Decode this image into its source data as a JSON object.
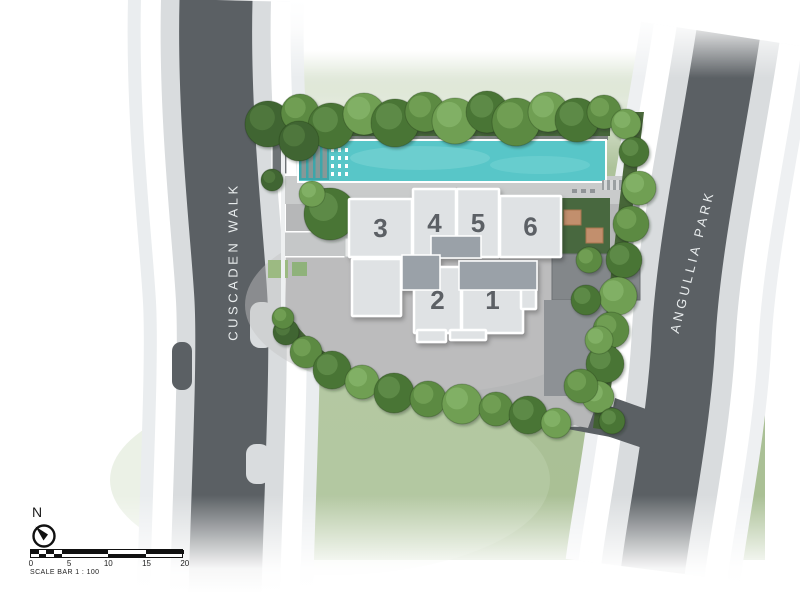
{
  "canvas": {
    "width": 800,
    "height": 593
  },
  "roads": {
    "left_label": "CUSCADEN WALK",
    "right_label": "ANGULLIA PARK"
  },
  "compass": {
    "label": "N"
  },
  "scale_bar": {
    "ticks": [
      "0",
      "5",
      "10",
      "15",
      "20"
    ],
    "caption": "SCALE BAR 1 : 100",
    "checker_cells": 5,
    "blocks": [
      "top",
      "bottom",
      "top"
    ]
  },
  "building": {
    "fill": "#dfe2e4",
    "core_fill": "#9aa1a8",
    "stroke": "#ffffff",
    "label_color": "#5b6065",
    "units": [
      {
        "label": "3",
        "x": 349,
        "y": 199,
        "w": 63,
        "h": 58
      },
      {
        "label": "4",
        "x": 413,
        "y": 189,
        "w": 43,
        "h": 68
      },
      {
        "label": "5",
        "x": 457,
        "y": 189,
        "w": 42,
        "h": 68
      },
      {
        "label": "6",
        "x": 500,
        "y": 196,
        "w": 61,
        "h": 61
      },
      {
        "label": "",
        "x": 352,
        "y": 259,
        "w": 49,
        "h": 57
      },
      {
        "label": "2",
        "x": 414,
        "y": 267,
        "w": 47,
        "h": 66
      },
      {
        "label": "1",
        "x": 462,
        "y": 267,
        "w": 61,
        "h": 66
      },
      {
        "label": "",
        "x": 521,
        "y": 271,
        "w": 15,
        "h": 38
      },
      {
        "label": "",
        "x": 417,
        "y": 330,
        "w": 29,
        "h": 12
      },
      {
        "label": "",
        "x": 450,
        "y": 330,
        "w": 36,
        "h": 10
      }
    ],
    "cores": [
      {
        "x": 431,
        "y": 236,
        "w": 50,
        "h": 22
      },
      {
        "x": 402,
        "y": 255,
        "w": 38,
        "h": 35
      },
      {
        "x": 459,
        "y": 261,
        "w": 78,
        "h": 29
      }
    ]
  },
  "landscape": {
    "tree_palette": [
      "#4a7435",
      "#5c8a42",
      "#6f9f52",
      "#3f6530"
    ],
    "tree_highlight": [
      "#6d9c55",
      "#7fae63",
      "#8fbd74",
      "#5d8747"
    ],
    "trees": [
      [
        268,
        124,
        23,
        3
      ],
      [
        300,
        113,
        19,
        1
      ],
      [
        331,
        126,
        23,
        0
      ],
      [
        364,
        114,
        21,
        2
      ],
      [
        395,
        123,
        24,
        0
      ],
      [
        425,
        112,
        20,
        1
      ],
      [
        455,
        121,
        23,
        2
      ],
      [
        487,
        112,
        21,
        0
      ],
      [
        516,
        122,
        24,
        1
      ],
      [
        548,
        112,
        20,
        2
      ],
      [
        577,
        120,
        22,
        0
      ],
      [
        604,
        112,
        17,
        1
      ],
      [
        626,
        124,
        15,
        2
      ],
      [
        634,
        152,
        15,
        0
      ],
      [
        639,
        188,
        17,
        2
      ],
      [
        631,
        224,
        18,
        1
      ],
      [
        624,
        260,
        18,
        0
      ],
      [
        618,
        296,
        19,
        2
      ],
      [
        611,
        330,
        18,
        1
      ],
      [
        605,
        364,
        19,
        0
      ],
      [
        598,
        397,
        16,
        2
      ],
      [
        589,
        260,
        13,
        1
      ],
      [
        586,
        300,
        15,
        0
      ],
      [
        599,
        340,
        14,
        2
      ],
      [
        581,
        386,
        17,
        1
      ],
      [
        612,
        421,
        13,
        0
      ],
      [
        286,
        332,
        13,
        3
      ],
      [
        306,
        352,
        16,
        1
      ],
      [
        332,
        370,
        19,
        0
      ],
      [
        362,
        382,
        17,
        2
      ],
      [
        394,
        393,
        20,
        0
      ],
      [
        428,
        399,
        18,
        1
      ],
      [
        462,
        404,
        20,
        2
      ],
      [
        496,
        409,
        17,
        1
      ],
      [
        528,
        415,
        19,
        0
      ],
      [
        556,
        423,
        15,
        2
      ],
      [
        299,
        141,
        20,
        3
      ],
      [
        330,
        214,
        26,
        0
      ],
      [
        312,
        194,
        13,
        2
      ],
      [
        272,
        180,
        11,
        3
      ],
      [
        283,
        318,
        11,
        1
      ]
    ]
  },
  "colors": {
    "grass": "#adc29a",
    "lawn_light": "#c6d6b6",
    "asphalt": "#5b6064",
    "sidewalk": "#d9dcde",
    "outer_walk": "#eaedef",
    "deck": "#c9cbcb",
    "paving": "#b6b7b8",
    "pool": "#58c6c8",
    "pool_dark": "#3da6aa",
    "hedge": "#40602f",
    "planting": "#48683f",
    "daybed": "#c28f6d",
    "dark_court": "#83878a",
    "wall": "#6e7376"
  }
}
